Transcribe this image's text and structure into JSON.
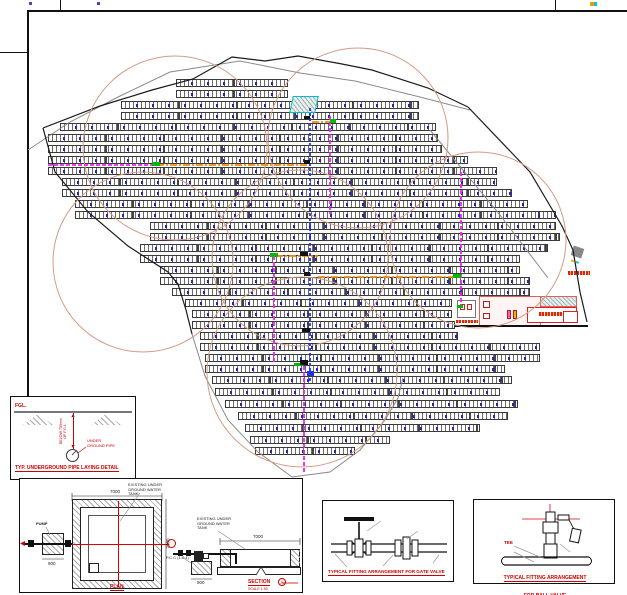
{
  "sheet": {
    "bg": "#ffffff",
    "frame_color": "#111111"
  },
  "site": {
    "colors": {
      "circle": "#d49b85",
      "magenta": "#ee22ee",
      "blue": "#2233ee",
      "orange": "#ff8800",
      "green": "#00bb00",
      "cyan": "#00bbcc",
      "building": "#e06060",
      "boundary": "#1a1a1a",
      "contour": "#8a8a8a"
    },
    "panel_rows": [
      [
        79,
        176,
        288
      ],
      [
        90,
        176,
        288
      ],
      [
        101,
        121,
        419
      ],
      [
        112,
        121,
        419
      ],
      [
        123,
        60,
        436
      ],
      [
        134,
        48,
        438
      ],
      [
        145,
        48,
        442
      ],
      [
        156,
        48,
        468
      ],
      [
        167,
        48,
        497
      ],
      [
        178,
        62,
        497
      ],
      [
        189,
        62,
        512
      ],
      [
        200,
        75,
        528
      ],
      [
        211,
        75,
        556
      ],
      [
        222,
        150,
        556
      ],
      [
        233,
        150,
        560
      ],
      [
        244,
        140,
        548
      ],
      [
        255,
        140,
        520
      ],
      [
        266,
        160,
        520
      ],
      [
        277,
        160,
        530
      ],
      [
        288,
        172,
        530
      ],
      [
        299,
        185,
        452
      ],
      [
        310,
        192,
        452
      ],
      [
        321,
        192,
        455
      ],
      [
        332,
        200,
        458
      ],
      [
        343,
        200,
        540
      ],
      [
        354,
        205,
        540
      ],
      [
        365,
        205,
        505
      ],
      [
        376,
        212,
        512
      ],
      [
        388,
        215,
        500
      ],
      [
        400,
        225,
        518
      ],
      [
        412,
        238,
        508
      ],
      [
        424,
        245,
        480
      ],
      [
        436,
        250,
        390
      ],
      [
        447,
        255,
        355
      ]
    ],
    "circles": [
      [
        175,
        148,
        92
      ],
      [
        358,
        138,
        90
      ],
      [
        300,
        258,
        88
      ],
      [
        478,
        240,
        88
      ],
      [
        143,
        262,
        90
      ],
      [
        302,
        372,
        95
      ]
    ],
    "black_lines": [
      "43,128 100,106 152,90 193,79 232,57 265,61 298,56 342,64 372,70 428,88 468,107",
      "468,107 530,172 562,226 573,250 580,292 587,322",
      "43,128 55,172 88,212 128,246 168,272 178,284 186,310 192,334"
    ],
    "gray_lines": [
      "192,334 205,376 228,420 258,452 292,477 330,472 360,450 385,420 398,398 403,378",
      "430,130 500,215 548,278",
      "28,150 70,122 120,96 170,72 240,61 300,73 355,81 420,97 470,110"
    ],
    "pipes": [
      {
        "x1": 48,
        "y1": 165,
        "x2": 157,
        "y2": 165,
        "kind": "magenta"
      },
      {
        "x1": 157,
        "y1": 165,
        "x2": 312,
        "y2": 165,
        "kind": "orange"
      },
      {
        "x1": 312,
        "y1": 122,
        "x2": 334,
        "y2": 122,
        "kind": "orange"
      },
      {
        "x1": 276,
        "y1": 256,
        "x2": 318,
        "y2": 256,
        "kind": "orange"
      },
      {
        "x1": 318,
        "y1": 277,
        "x2": 457,
        "y2": 277,
        "kind": "orange"
      },
      {
        "x1": 310,
        "y1": 108,
        "x2": 310,
        "y2": 382,
        "kind": "blue"
      },
      {
        "x1": 330,
        "y1": 116,
        "x2": 330,
        "y2": 214,
        "kind": "magenta"
      },
      {
        "x1": 274,
        "y1": 256,
        "x2": 274,
        "y2": 362,
        "kind": "magenta"
      },
      {
        "x1": 461,
        "y1": 172,
        "x2": 461,
        "y2": 308,
        "kind": "magenta"
      },
      {
        "x1": 304,
        "y1": 366,
        "x2": 304,
        "y2": 472,
        "kind": "magenta"
      }
    ],
    "green_marks": [
      [
        152,
        162,
        8,
        4
      ],
      [
        270,
        253,
        8,
        4
      ],
      [
        453,
        274,
        8,
        4
      ],
      [
        330,
        119,
        6,
        4
      ],
      [
        294,
        363,
        10,
        3
      ],
      [
        457,
        305,
        6,
        3
      ]
    ],
    "black_marks": [
      [
        304,
        116,
        6,
        3
      ],
      [
        304,
        160,
        6,
        4
      ],
      [
        300,
        252,
        8,
        4
      ],
      [
        304,
        272,
        6,
        4
      ],
      [
        302,
        328,
        8,
        4
      ],
      [
        300,
        360,
        8,
        5
      ]
    ],
    "blue_marks": [
      [
        307,
        371,
        7,
        5
      ]
    ]
  },
  "details": {
    "underground": {
      "fgl": "FGL.",
      "depth_line1": "BELOW 750mm",
      "depth_line2": "OF F.G.L.",
      "pipe_label_1": "UNDER",
      "pipe_label_2": "GROUND PIPE",
      "title": "TYP. UNDERGROUND PIPE LAYING DETAIL"
    },
    "plan": {
      "pump": "PUMP",
      "tank_1": "EXISTING UNDER",
      "tank_2": "GROUND WATER",
      "tank_3": "TANK",
      "dim_top": "7000",
      "dim_side": "7000",
      "dim_pump": "900",
      "title": "PLAN"
    },
    "section": {
      "tank_1": "EXISTING UNDER",
      "tank_2": "GROUND WATER",
      "tank_3": "TANK",
      "dim_top": "7000",
      "pcc": "P.C.C (1:2:4)",
      "dim_pump": "900",
      "title": "SECTION",
      "marker": "A",
      "scale": "SCALE 1:50"
    },
    "gate_valve": {
      "title": "TYPICAL FITTING ARRANGEMENT FOR GATE VALVE"
    },
    "ball_valve": {
      "tee": "TEE",
      "title_line1": "TYPICAL FITTING ARRANGEMENT",
      "title_line2": "FOR BALL VALVE"
    }
  }
}
